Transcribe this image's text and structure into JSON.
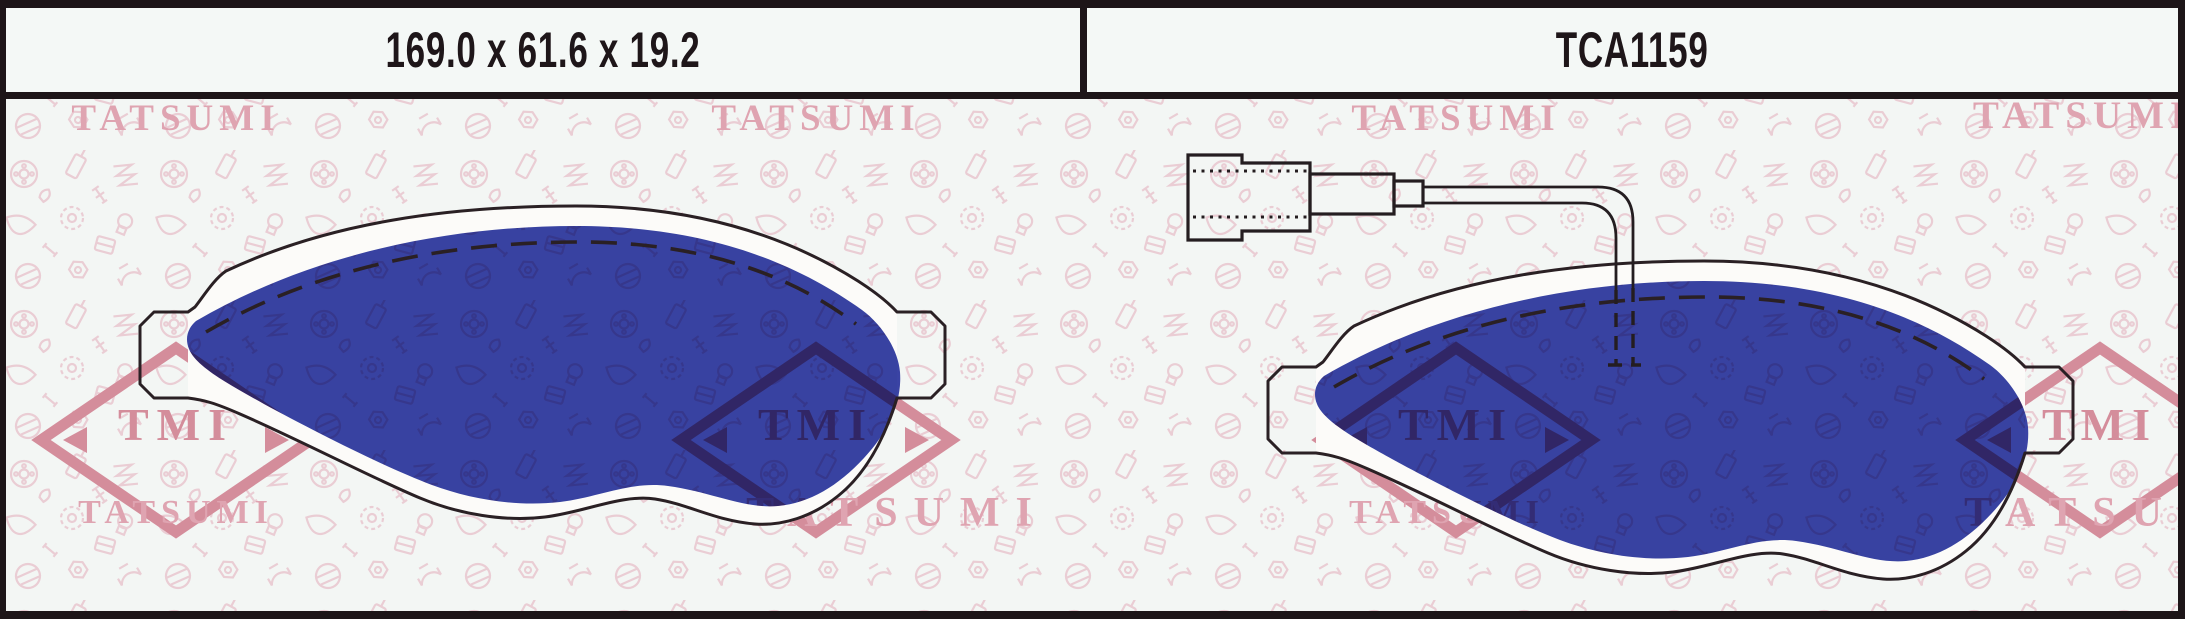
{
  "header": {
    "dimensions_label": "169.0 x 61.6 x 19.2",
    "part_number": "TCA1159"
  },
  "watermarks": {
    "brand_text": "TATSUMI",
    "logo_text": "TMI"
  },
  "colors": {
    "friction_blue": "#3a44a8",
    "outline_black": "#2a2024",
    "watermark_pink": "#dfa4b1",
    "logo_pink": "#d48d9b",
    "pattern_pink": "#eacdd4",
    "paper": "#f3f6f4",
    "frame_black": "#1d1518"
  }
}
